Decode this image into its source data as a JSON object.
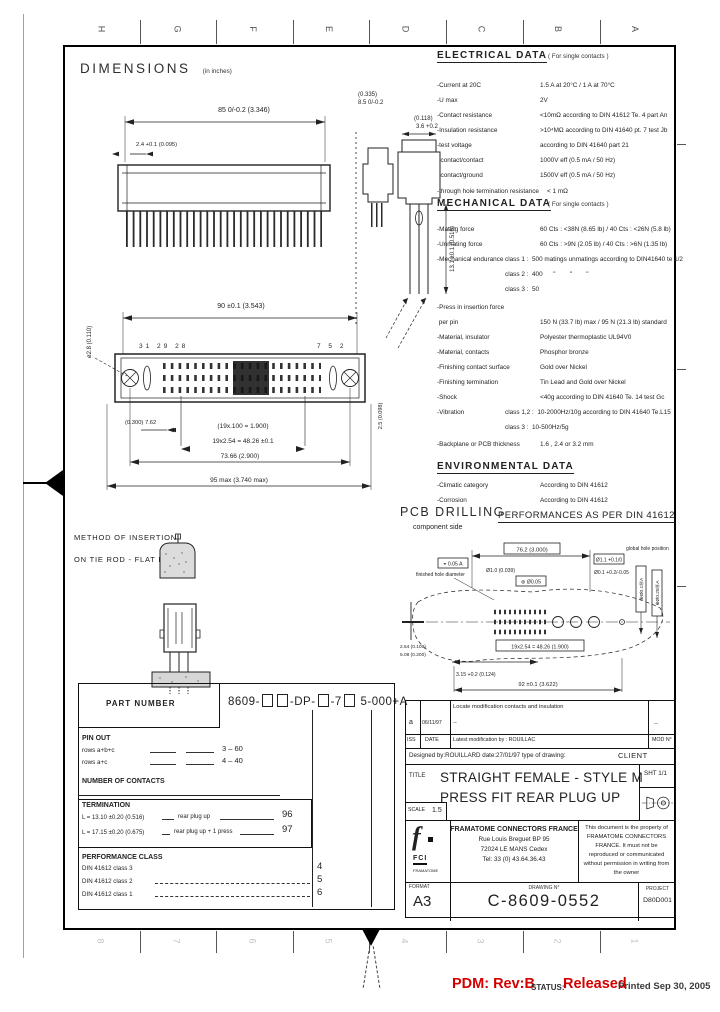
{
  "colors": {
    "accent_red": "#d40000",
    "ink": "#1c1c1c"
  },
  "frame": {
    "zones_top": [
      "H",
      "G",
      "F",
      "E",
      "D",
      "C",
      "B",
      "A"
    ],
    "zones_bottom": [
      "8",
      "7",
      "6",
      "5",
      "4",
      "3",
      "2",
      "1"
    ]
  },
  "header": {
    "title": "DIMENSIONS",
    "units_note": "(in inches)"
  },
  "top_view": {
    "dim_width": "85 0/-0.2  (3.346)",
    "dim_pin": "2.4 +0.1 (0.095)"
  },
  "side_view": {
    "dim_a1": "(0.335)",
    "dim_a2": "8.5 0/-0.2",
    "dim_b1": "(0.118)",
    "dim_b2": "3.6 +0.2",
    "dim_len": "13.1 ±0.1 (0.516)"
  },
  "front_view": {
    "dim_top": "90 ±0.1  (3.543)",
    "pins_left": "31  29  28",
    "pins_right": "7  5  2",
    "hole": "ø2.8 (0.110)",
    "pitch_in": "(19x.100 = 1.900)",
    "pitch_mm": "19x2.54 = 48.26 ±0.1",
    "dim_small": "(0.300) 7.62",
    "dim_mount": "73.66  (2.900)",
    "dim_overall": "95 max  (3.740 max)",
    "dim_right": "2.5 (0.098)"
  },
  "electrical": {
    "heading": "ELECTRICAL DATA",
    "note": "( For single contacts )",
    "rows": [
      {
        "label": "-Current at 20C",
        "value": "1.5 A at 20°C / 1 A at 70°C"
      },
      {
        "label": "-U max",
        "value": "2V"
      },
      {
        "label": "-Contact resistance",
        "value": "<10mΩ according to DIN 41612 Te. 4 part An"
      },
      {
        "label": "-Insulation resistance",
        "value": ">10⁴MΩ according to DIN 41640 pt. 7 test Jb"
      },
      {
        "label": "-test voltage",
        "value": "according to DIN 41640 part 21"
      },
      {
        "label": "  contact/contact",
        "value": "1000V eff (0.5 mA / 50 Hz)"
      },
      {
        "label": "  contact/ground",
        "value": "1500V eff (0.5 mA / 50 Hz)"
      },
      {
        "label": "-through hole termination resistance",
        "value": "< 1 mΩ"
      }
    ]
  },
  "mechanical": {
    "heading": "MECHANICAL DATA",
    "note": "( For single contacts )",
    "rows": [
      {
        "label": "-Mating force",
        "value": "60 Cts : <38N (8.65 lb) / 40 Cts : <26N (5.8 lb)"
      },
      {
        "label": "-Unmating force",
        "value": "60 Cts : >9N (2.05 lb) / 40 Cts : >6N (1.35 lb)"
      },
      {
        "label": "-Mechanical endurance",
        "value": "class 1 :  500 matings unmatings according to DIN41640 te 1/2"
      },
      {
        "label": "",
        "value": "class 2 :  400      \"        \"        \""
      },
      {
        "label": "",
        "value": "class 3 :  50"
      },
      {
        "label": "-Press in insertion force",
        "value": ""
      },
      {
        "label": " per pin",
        "value": "150 N (33.7 lb) max / 95 N (21.3 lb) standard"
      },
      {
        "label": "-Material, insulator",
        "value": "Polyester thermoplastic UL94V0"
      },
      {
        "label": "-Material, contacts",
        "value": "Phosphor bronze"
      },
      {
        "label": "-Finishing contact surface",
        "value": "Gold over Nickel"
      },
      {
        "label": "-Finishing termination",
        "value": "Tin Lead and Gold over Nickel"
      },
      {
        "label": "-Shock",
        "value": "<40g according to DIN 41640 Te. 14 test Gc"
      },
      {
        "label": "-Vibration",
        "value": "class 1,2 :  10-2000Hz/10g according to DIN 41640 Te.L15"
      },
      {
        "label": "",
        "value": "class 3 :  10-500Hz/5g"
      },
      {
        "label": "-Backplane or PCB thickness",
        "value": "1.6 , 2.4 or 3.2 mm"
      }
    ]
  },
  "environmental": {
    "heading": "ENVIRONMENTAL DATA",
    "rows": [
      {
        "label": "-Climatic category",
        "value": "According to DIN 41612"
      },
      {
        "label": "-Corrosion",
        "value": "According to DIN 41612"
      }
    ]
  },
  "pcb": {
    "title": "PCB DRILLING",
    "subtitle": "component side",
    "performance": "PERFORMANCES AS PER DIN 41612",
    "datum_tol": "⌖ 0.05 A",
    "span": "76.2 (3.000)",
    "hole_tol": "Ø1.1 +0.1/0",
    "global_note": "global hole position",
    "finished_note": "finished hole diameter",
    "hole_dia": "Ø1.0 (0.039)",
    "pos_tol": "⊕ Ø0.05",
    "small_tol": "Ø0.1 +0.2/-0.05",
    "fcf1": "⊕Ø0.1ⓂA",
    "fcf2": "⊕Ø0.25ⓂA",
    "left_dim1": "2.54 (0.100)",
    "left_dim2": "5.08 (0.200)",
    "pitch": "19x2.54 = 48.26 (1.900)",
    "offset": "3.15 +0.2 (0.124)",
    "bottom": "92 ±0.1 (3.622)"
  },
  "insertion": {
    "line1": "METHOD OF INSERTION",
    "line2": "ON TIE ROD - FLAT ROCK"
  },
  "part_table": {
    "header": "PART NUMBER",
    "pn_prefix": "8609-",
    "pn_mid1": "-DP-",
    "pn_mid2": "-7",
    "pn_suffix": "5-000+A",
    "pin_out_heading": "PIN OUT",
    "pin_rows": [
      {
        "label": "rows a+b+c",
        "value": "3 – 60"
      },
      {
        "label": "rows a+c",
        "value": "4 – 40"
      }
    ],
    "contacts_heading": "NUMBER OF CONTACTS",
    "termination_heading": "TERMINATION",
    "term_rows": [
      {
        "label": "L = 13.10 ±0.20 (0.516)",
        "desc": "rear plug up",
        "value": "96"
      },
      {
        "label": "L = 17.15 ±0.20 (0.675)",
        "desc": "rear plug up + 1 press",
        "value": "97"
      }
    ],
    "class_heading": "PERFORMANCE CLASS",
    "class_rows": [
      {
        "label": "DIN 41612 class 3",
        "value": "4"
      },
      {
        "label": "DIN 41612 class 2",
        "value": "5"
      },
      {
        "label": "DIN 41612 class 1",
        "value": "6"
      }
    ]
  },
  "title_block": {
    "rev": {
      "iss": "a",
      "date": "06/11/97",
      "desc1": "Locate modification contacts and insulation",
      "desc2": "--",
      "mod": "--"
    },
    "rev_header": {
      "iss": "ISS",
      "date": "DATE",
      "by": "Latest modification by : ROUILLAC",
      "mod": "MOD N°"
    },
    "designed": "Designed by:ROUILLARD  date:27/01/97  type of drawing:",
    "drawing_type": "CLIENT",
    "title_label": "TITLE",
    "title_line1": "STRAIGHT FEMALE - STYLE M",
    "title_line2": "PRESS FIT REAR PLUG UP",
    "scale_label": "SCALE",
    "scale": "1.5",
    "sheet": "SHT 1/1",
    "logo": {
      "glyph": "f",
      "text": "FCI",
      "sub": "FRAMATOME"
    },
    "company": {
      "name": "FRAMATOME CONNECTORS FRANCE",
      "addr1": "Rue Louis Breguet   BP 95",
      "addr2": "72024  LE MANS Cedex",
      "addr3": "Tel: 33 (0) 43.64.36.43"
    },
    "property_note": "This document is the property of FRAMATOME CONNECTORS FRANCE. It must not be reproduced or communicated without permission in writing from the owner",
    "format_label": "FORMAT",
    "format": "A3",
    "number_label": "DRAWING N°",
    "number": "C-8609-0552",
    "project_label": "PROJECT",
    "project": "D80D001"
  },
  "footer": {
    "pdm": "PDM: Rev:B",
    "status_label": "STATUS:",
    "status": "Released",
    "printed": "Printed Sep 30, 2005"
  }
}
